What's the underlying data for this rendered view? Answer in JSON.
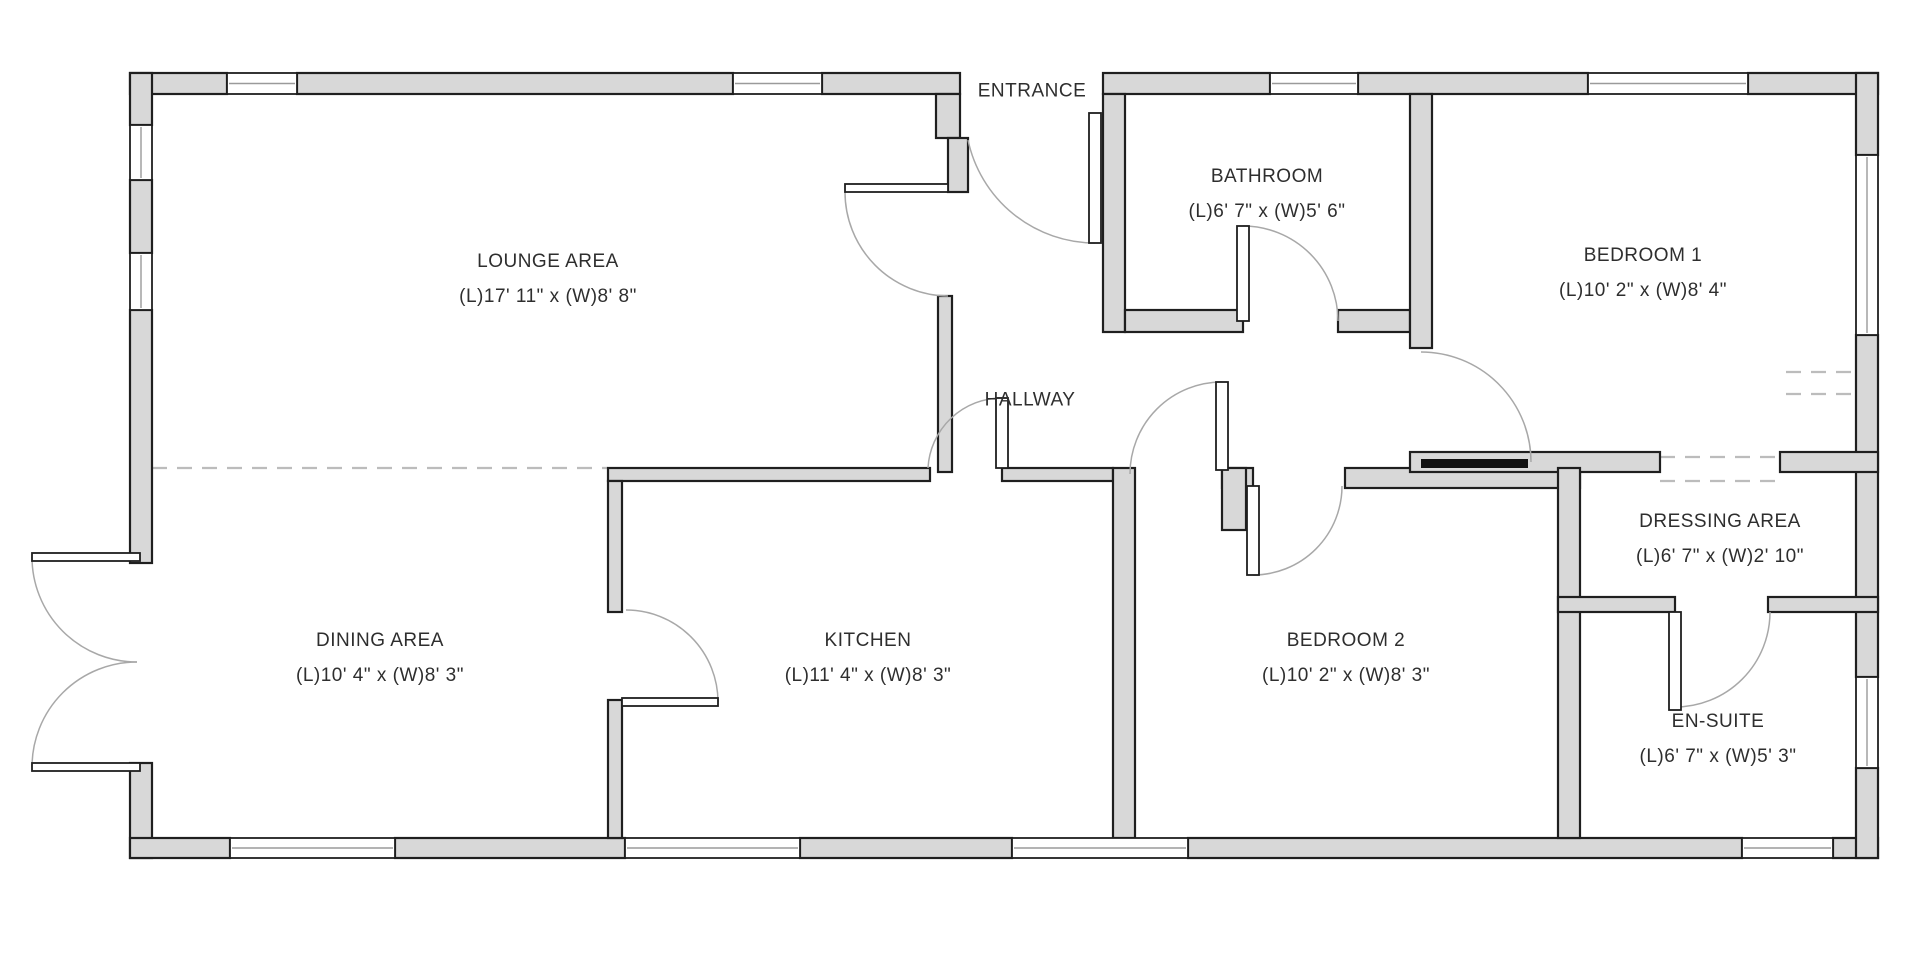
{
  "rooms": [
    {
      "name": "LOUNGE AREA",
      "dims": "(L)17' 11\" x (W)8' 8\""
    },
    {
      "name": "DINING AREA",
      "dims": "(L)10' 4\" x (W)8' 3\""
    },
    {
      "name": "KITCHEN",
      "dims": "(L)11' 4\" x (W)8' 3\""
    },
    {
      "name": "HALLWAY",
      "dims": ""
    },
    {
      "name": "ENTRANCE",
      "dims": ""
    },
    {
      "name": "BATHROOM",
      "dims": "(L)6' 7\" x (W)5' 6\""
    },
    {
      "name": "BEDROOM 1",
      "dims": "(L)10' 2\" x (W)8' 4\""
    },
    {
      "name": "BEDROOM 2",
      "dims": "(L)10' 2\" x (W)8' 3\""
    },
    {
      "name": "DRESSING AREA",
      "dims": "(L)6' 7\" x (W)2' 10\""
    },
    {
      "name": "EN-SUITE",
      "dims": "(L)6' 7\" x (W)5' 3\""
    }
  ],
  "plan": {
    "canvas": {
      "width": 1920,
      "height": 957
    },
    "colors": {
      "wall_fill": "#d8d8d8",
      "outline": "#1f1f1f",
      "arc": "#a8a8a8",
      "dash": "#bcbcbc"
    },
    "walls": [
      [
        130,
        73,
        97,
        21
      ],
      [
        297,
        73,
        436,
        21
      ],
      [
        822,
        73,
        138,
        21
      ],
      [
        1103,
        73,
        167,
        21
      ],
      [
        1358,
        73,
        230,
        21
      ],
      [
        1748,
        73,
        130,
        21
      ],
      [
        130,
        73,
        22,
        52
      ],
      [
        130,
        180,
        22,
        73
      ],
      [
        130,
        310,
        22,
        253
      ],
      [
        130,
        763,
        22,
        95
      ],
      [
        130,
        838,
        100,
        20
      ],
      [
        395,
        838,
        230,
        20
      ],
      [
        800,
        838,
        212,
        20
      ],
      [
        1188,
        838,
        554,
        20
      ],
      [
        1833,
        838,
        45,
        20
      ],
      [
        1856,
        73,
        22,
        82
      ],
      [
        1856,
        335,
        22,
        342
      ],
      [
        1856,
        768,
        22,
        90
      ],
      [
        936,
        94,
        24,
        44
      ],
      [
        948,
        138,
        20,
        54
      ],
      [
        938,
        296,
        14,
        176
      ],
      [
        1103,
        94,
        22,
        238
      ],
      [
        1125,
        310,
        118,
        22
      ],
      [
        1338,
        310,
        72,
        22
      ],
      [
        1410,
        94,
        22,
        254
      ],
      [
        608,
        468,
        322,
        13
      ],
      [
        1002,
        468,
        111,
        13
      ],
      [
        608,
        481,
        14,
        131
      ],
      [
        608,
        700,
        14,
        138
      ],
      [
        1113,
        468,
        22,
        370
      ],
      [
        1222,
        468,
        31,
        20
      ],
      [
        1222,
        468,
        24,
        62
      ],
      [
        1345,
        468,
        235,
        20
      ],
      [
        1410,
        452,
        250,
        20
      ],
      [
        1780,
        452,
        98,
        20
      ],
      [
        1558,
        468,
        22,
        370
      ],
      [
        1558,
        597,
        117,
        15
      ],
      [
        1768,
        597,
        110,
        15
      ]
    ],
    "windows": [
      [
        227,
        73,
        70,
        21
      ],
      [
        733,
        73,
        89,
        21
      ],
      [
        1270,
        73,
        88,
        21
      ],
      [
        1588,
        73,
        160,
        21
      ],
      [
        230,
        838,
        165,
        20
      ],
      [
        625,
        838,
        175,
        20
      ],
      [
        1012,
        838,
        176,
        20
      ],
      [
        1742,
        838,
        91,
        20
      ],
      [
        130,
        125,
        22,
        55
      ],
      [
        130,
        253,
        22,
        57
      ],
      [
        1856,
        155,
        22,
        180
      ],
      [
        1856,
        677,
        22,
        91
      ]
    ],
    "door_leaves": [
      [
        32,
        553,
        108,
        8
      ],
      [
        32,
        763,
        108,
        8
      ],
      [
        1089,
        113,
        12,
        130
      ],
      [
        845,
        184,
        103,
        8
      ],
      [
        1237,
        226,
        12,
        95
      ],
      [
        996,
        398,
        12,
        70
      ],
      [
        1216,
        382,
        12,
        88
      ],
      [
        1247,
        486,
        12,
        89
      ],
      [
        1669,
        612,
        12,
        98
      ],
      [
        622,
        698,
        96,
        8
      ]
    ],
    "black_bars": [
      [
        1421,
        459,
        107,
        9
      ]
    ],
    "arcs": [
      "M 32 557 A 105 105 0 0 0 137 662",
      "M 32 767 A 105 105 0 0 1 137 662",
      "M 1095 243 A 130 130 0 0 1 968 140",
      "M 845 192 A 104 104 0 0 0 948 296",
      "M 1243 226 A 95 95 0 0 1 1338 321",
      "M 1002 398 A 74 74 0 0 0 928 468",
      "M 1222 382 A 92 92 0 0 0 1130 474",
      "M 1253 575 A 89 89 0 0 0 1342 486",
      "M 1675 707 A 95 95 0 0 0 1770 612",
      "M 626 610 A 92 92 0 0 1 718 702",
      "M 1421 352 A 110 110 0 0 1 1531 462"
    ],
    "dashed": [
      "M 152 468 L 608 468",
      "M 1660 457 L 1780 457",
      "M 1660 481 L 1780 481",
      "M 1786 372 L 1856 372",
      "M 1786 394 L 1856 394"
    ]
  }
}
